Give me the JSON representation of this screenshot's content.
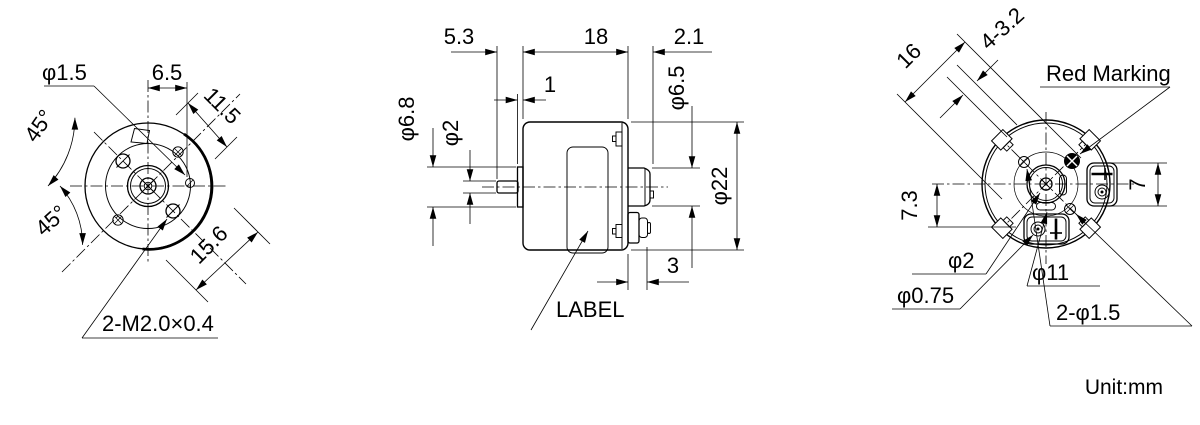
{
  "front": {
    "phi_1_5": "φ1.5",
    "dim_6_5": "6.5",
    "dim_11_5": "11.5",
    "angle_upper": "45°",
    "angle_lower": "45°",
    "dim_15_6": "15.6",
    "thread_note": "2-M2.0×0.4"
  },
  "side": {
    "dim_5_3": "5.3",
    "dim_18": "18",
    "dim_2_1": "2.1",
    "dim_1": "1",
    "phi_6_8": "φ6.8",
    "phi_2": "φ2",
    "phi_6_5": "φ6.5",
    "phi_22": "φ22",
    "dim_3": "3",
    "label_note": "LABEL"
  },
  "back": {
    "dim_16": "16",
    "dim_4_3_2": "4-3.2",
    "red_marking": "Red Marking",
    "dim_7": "7",
    "dim_7_3": "7.3",
    "phi_2": "φ2",
    "phi_0_75": "φ0.75",
    "phi_11": "φ11",
    "dim_2_phi_1_5": "2-φ1.5"
  },
  "footer": {
    "unit": "Unit:mm"
  }
}
